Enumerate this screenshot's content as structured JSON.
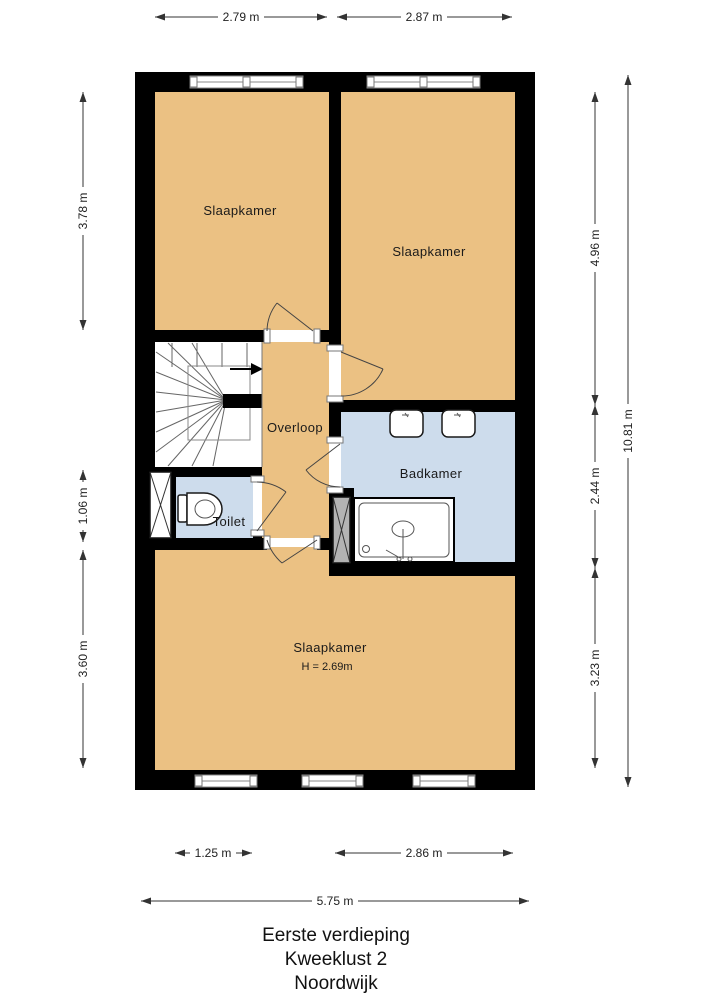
{
  "title": {
    "line1": "Eerste verdieping",
    "line2": "Kweeklust 2",
    "line3": "Noordwijk"
  },
  "rooms": {
    "bedroom_top_left": "Slaapkamer",
    "bedroom_top_right": "Slaapkamer",
    "landing": "Overloop",
    "bathroom": "Badkamer",
    "toilet": "Toilet",
    "bedroom_bottom": "Slaapkamer",
    "bedroom_bottom_height": "H = 2.69m"
  },
  "dimensions": {
    "top": [
      "2.79 m",
      "2.87 m"
    ],
    "left": [
      "3.78 m",
      "1.06 m",
      "3.60 m"
    ],
    "right_inner": [
      "4.96 m",
      "2.44 m",
      "3.23 m"
    ],
    "right_total": "10.81 m",
    "bottom": [
      "1.25 m",
      "2.86 m"
    ],
    "bottom_total": "5.75 m"
  },
  "colors": {
    "room_fill": "#ebc183",
    "wet_room_fill": "#cddcec",
    "wall": "#000000"
  }
}
